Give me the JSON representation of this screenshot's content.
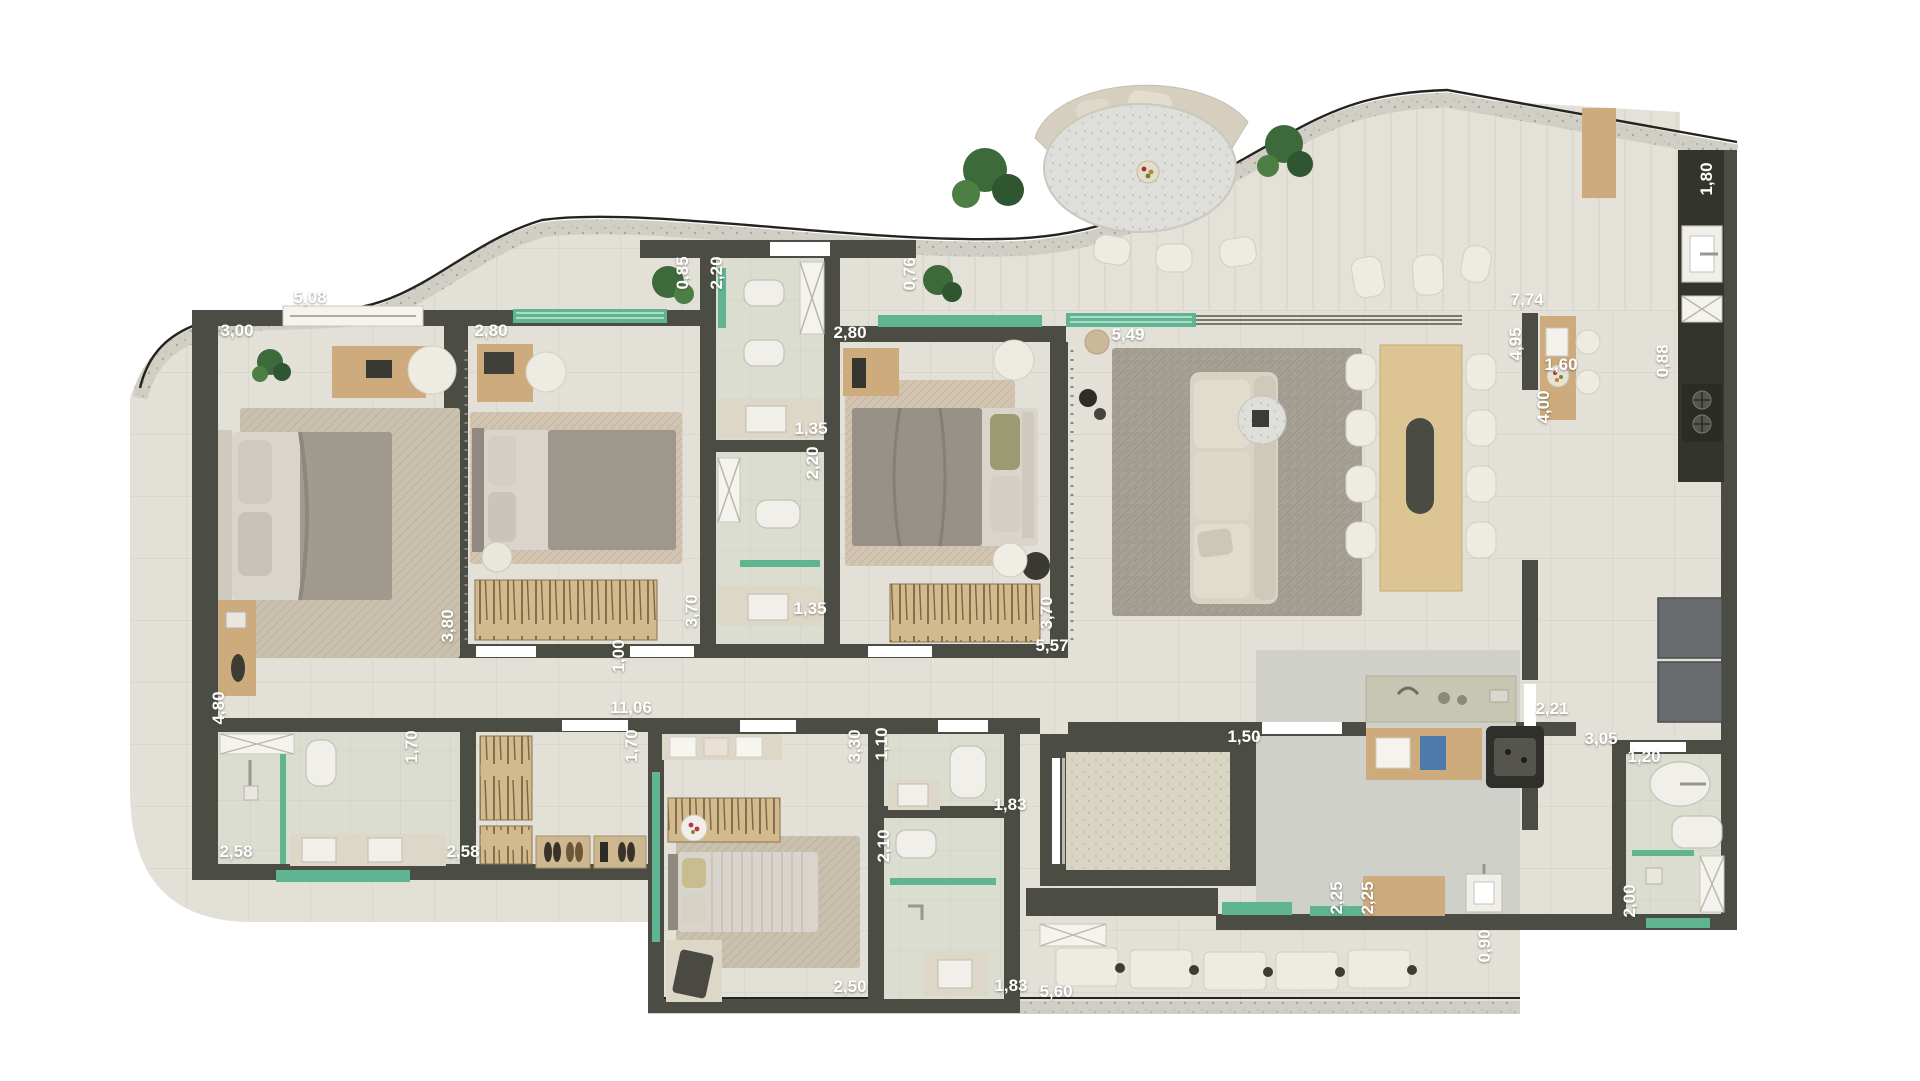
{
  "plan": {
    "type": "apartment-floor-plan-top-view",
    "units": "meters-comma-decimal",
    "colors": {
      "background": "#ffffff",
      "slab_floor": "#e2e0d7",
      "wall": "#4b4c43",
      "dark_counter": "#33342c",
      "window_glass": "#5fb592",
      "wood": "#cdab7c",
      "gray_service_floor": "#d0d0ca",
      "rug_beige": "#c9c0ae",
      "rug_gray": "#a7a094",
      "label_text": "#ffffff"
    },
    "dimensions": [
      {
        "text": "5,08",
        "x": 310,
        "y": 303,
        "rot": 0
      },
      {
        "text": "3,00",
        "x": 237,
        "y": 336,
        "rot": 0
      },
      {
        "text": "2,80",
        "x": 491,
        "y": 336,
        "rot": 0
      },
      {
        "text": "0,85",
        "x": 688,
        "y": 273,
        "rot": -90
      },
      {
        "text": "2,20",
        "x": 722,
        "y": 273,
        "rot": -90
      },
      {
        "text": "0,76",
        "x": 915,
        "y": 274,
        "rot": -90
      },
      {
        "text": "2,80",
        "x": 850,
        "y": 338,
        "rot": 0
      },
      {
        "text": "5,49",
        "x": 1128,
        "y": 340,
        "rot": 0
      },
      {
        "text": "7,74",
        "x": 1527,
        "y": 305,
        "rot": 0
      },
      {
        "text": "4,95",
        "x": 1521,
        "y": 344,
        "rot": -90
      },
      {
        "text": "1,60",
        "x": 1561,
        "y": 370,
        "rot": 0
      },
      {
        "text": "0,88",
        "x": 1668,
        "y": 361,
        "rot": -90
      },
      {
        "text": "4,00",
        "x": 1549,
        "y": 407,
        "rot": -90
      },
      {
        "text": "1,80",
        "x": 1712,
        "y": 179,
        "rot": -90
      },
      {
        "text": "1,35",
        "x": 811,
        "y": 434,
        "rot": 0
      },
      {
        "text": "2,20",
        "x": 818,
        "y": 463,
        "rot": -90
      },
      {
        "text": "3,80",
        "x": 453,
        "y": 626,
        "rot": -90
      },
      {
        "text": "3,70",
        "x": 697,
        "y": 611,
        "rot": -90
      },
      {
        "text": "1,00",
        "x": 624,
        "y": 656,
        "rot": -90
      },
      {
        "text": "1,35",
        "x": 810,
        "y": 614,
        "rot": 0
      },
      {
        "text": "3,70",
        "x": 1052,
        "y": 613,
        "rot": -90
      },
      {
        "text": "5,57",
        "x": 1052,
        "y": 651,
        "rot": 0
      },
      {
        "text": "4,80",
        "x": 224,
        "y": 708,
        "rot": -90
      },
      {
        "text": "11,06",
        "x": 631,
        "y": 713,
        "rot": 0
      },
      {
        "text": "1,70",
        "x": 417,
        "y": 747,
        "rot": -90
      },
      {
        "text": "1,70",
        "x": 637,
        "y": 746,
        "rot": -90
      },
      {
        "text": "3,30",
        "x": 860,
        "y": 746,
        "rot": -90
      },
      {
        "text": "1,10",
        "x": 887,
        "y": 744,
        "rot": -90
      },
      {
        "text": "1,83",
        "x": 1010,
        "y": 810,
        "rot": 0
      },
      {
        "text": "1,50",
        "x": 1244,
        "y": 742,
        "rot": 0
      },
      {
        "text": "2,21",
        "x": 1552,
        "y": 714,
        "rot": 0
      },
      {
        "text": "3,05",
        "x": 1601,
        "y": 744,
        "rot": 0
      },
      {
        "text": "1,20",
        "x": 1644,
        "y": 762,
        "rot": 0
      },
      {
        "text": "2,10",
        "x": 889,
        "y": 846,
        "rot": -90
      },
      {
        "text": "2,58",
        "x": 236,
        "y": 857,
        "rot": 0
      },
      {
        "text": "2,58",
        "x": 463,
        "y": 857,
        "rot": 0
      },
      {
        "text": "2,50",
        "x": 850,
        "y": 992,
        "rot": 0
      },
      {
        "text": "1,83",
        "x": 1011,
        "y": 991,
        "rot": 0
      },
      {
        "text": "5,60",
        "x": 1056,
        "y": 997,
        "rot": 0
      },
      {
        "text": "2,25",
        "x": 1342,
        "y": 898,
        "rot": -90
      },
      {
        "text": "2,25",
        "x": 1373,
        "y": 898,
        "rot": -90
      },
      {
        "text": "0,90",
        "x": 1490,
        "y": 946,
        "rot": -90
      },
      {
        "text": "2,00",
        "x": 1635,
        "y": 901,
        "rot": -90
      }
    ]
  }
}
